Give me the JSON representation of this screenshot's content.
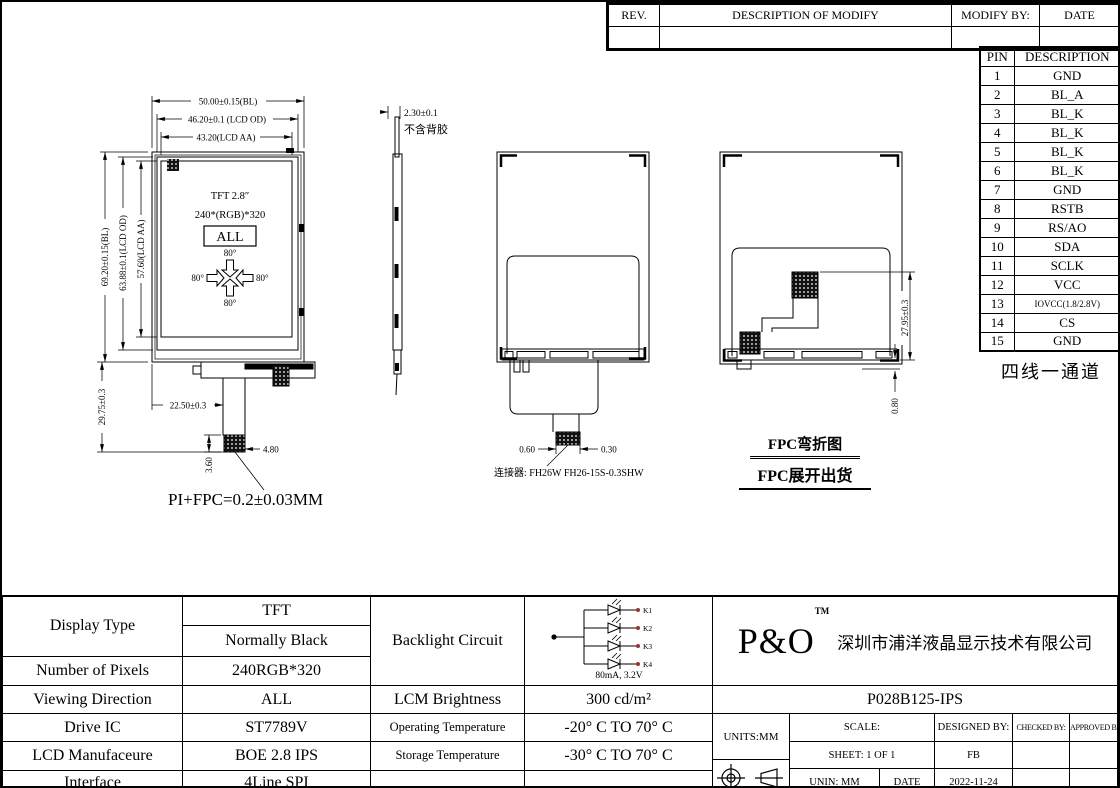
{
  "revision_table": {
    "col_rev": "REV.",
    "col_desc": "DESCRIPTION OF MODIFY",
    "col_by": "MODIFY BY:",
    "col_date": "DATE"
  },
  "pin_table": {
    "header_pin": "PIN",
    "header_desc": "DESCRIPTION",
    "rows": [
      [
        "1",
        "GND"
      ],
      [
        "2",
        "BL_A"
      ],
      [
        "3",
        "BL_K"
      ],
      [
        "4",
        "BL_K"
      ],
      [
        "5",
        "BL_K"
      ],
      [
        "6",
        "BL_K"
      ],
      [
        "7",
        "GND"
      ],
      [
        "8",
        "RSTB"
      ],
      [
        "9",
        "RS/AO"
      ],
      [
        "10",
        "SDA"
      ],
      [
        "11",
        "SCLK"
      ],
      [
        "12",
        "VCC"
      ],
      [
        "13",
        "IOVCC(1.8/2.8V)"
      ],
      [
        "14",
        "CS"
      ],
      [
        "15",
        "GND"
      ]
    ],
    "note": "四线一通道"
  },
  "views": {
    "front": {
      "dim_bl_w": "50.00±0.15(BL)",
      "dim_od_w": "46.20±0.1 (LCD OD)",
      "dim_aa_w": "43.20(LCD AA)",
      "dim_bl_h": "69.20±0.15(BL)",
      "dim_od_h": "63.88±0.1(LCD OD)",
      "dim_aa_h": "57.60(LCD AA)",
      "dim_fpc_len": "29.75±0.3",
      "dim_tail_off": "22.50±0.3",
      "dim_conn_w": "4.80",
      "dim_conn_h": "3.60",
      "screen_type": "TFT 2.8″",
      "screen_res": "240*(RGB)*320",
      "screen_dir": "ALL",
      "angle_top": "80°",
      "angle_left": "80°",
      "angle_right": "80°",
      "angle_bottom": "80°",
      "fpc_note": "PI+FPC=0.2±0.03MM"
    },
    "side": {
      "dim_thickness": "2.30±0.1",
      "thickness_note": "不含背胶"
    },
    "back": {
      "dim_left": "0.60",
      "dim_right": "0.30",
      "connector_note": "连接器: FH26W FH26-15S-0.3SHW"
    },
    "folded": {
      "dim_fpc": "27.95±0.3",
      "dim_gap": "0.80",
      "title_folded": "FPC弯折图",
      "title_unfolded": "FPC展开出货"
    }
  },
  "spec_table": {
    "display_type_label": "Display Type",
    "display_type_value1": "TFT",
    "display_type_value2": "Normally Black",
    "pixels_label": "Number of Pixels",
    "pixels_value": "240RGB*320",
    "viewing_label": "Viewing Direction",
    "viewing_value": "ALL",
    "drive_ic_label": "Drive IC",
    "drive_ic_value": "ST7789V",
    "manufacturer_label": "LCD Manufaceure",
    "manufacturer_value": "BOE 2.8 IPS",
    "interface_label": "Interface",
    "interface_value": "4Line SPI",
    "backlight_label": "Backlight Circuit",
    "led_labels": [
      "K1",
      "K2",
      "K3",
      "K4"
    ],
    "led_rating": "80mA, 3.2V",
    "brightness_label": "LCM Brightness",
    "brightness_value": "300 cd/m²",
    "op_temp_label": "Operating Temperature",
    "op_temp_value": "-20° C TO 70° C",
    "st_temp_label": "Storage Temperature",
    "st_temp_value": "-30° C TO 70° C"
  },
  "title_block": {
    "logo": "P&O",
    "logo_tm": "TM",
    "company": "深圳市浦洋液晶显示技术有限公司",
    "part_number": "P028B125-IPS",
    "units": "UNITS:MM",
    "scale_label": "SCALE:",
    "designed_label": "DESIGNED BY:",
    "checked_label": "CHECKED BY:",
    "approved_label": "APPROVED BY:",
    "sheet": "SHEET: 1 OF 1",
    "designed_value": "FB",
    "unin": "UNIN: MM",
    "date_label": "DATE",
    "date_value": "2022-11-24"
  }
}
